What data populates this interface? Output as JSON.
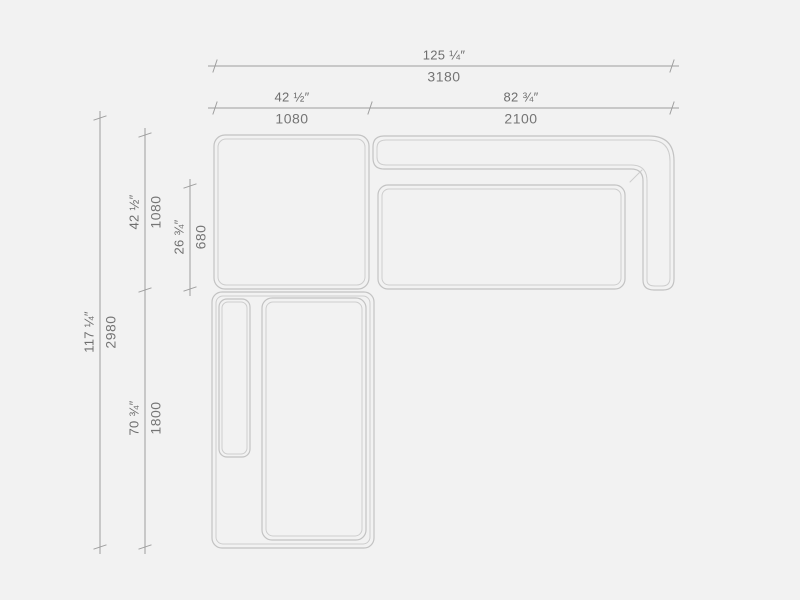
{
  "drawing": {
    "type": "sectional-sofa-top-view-technical-drawing",
    "colors": {
      "background": "#f2f2f2",
      "furniture_outline": "#c6c6c6",
      "furniture_outline_inner": "#cdcdcd",
      "dimension_line": "#9e9e9e",
      "text": "#6e6e6e"
    }
  },
  "dimensions": {
    "overall_width": {
      "imperial": "125 ¼″",
      "metric": "3180"
    },
    "corner_module_width": {
      "imperial": "42 ½″",
      "metric": "1080"
    },
    "sofa_module_width": {
      "imperial": "82 ¾″",
      "metric": "2100"
    },
    "overall_depth": {
      "imperial": "117 ¼″",
      "metric": "2980"
    },
    "corner_module_depth": {
      "imperial": "42 ½″",
      "metric": "1080"
    },
    "seat_depth": {
      "imperial": "26 ¾″",
      "metric": "680"
    },
    "chaise_length": {
      "imperial": "70 ¾″",
      "metric": "1800"
    }
  }
}
